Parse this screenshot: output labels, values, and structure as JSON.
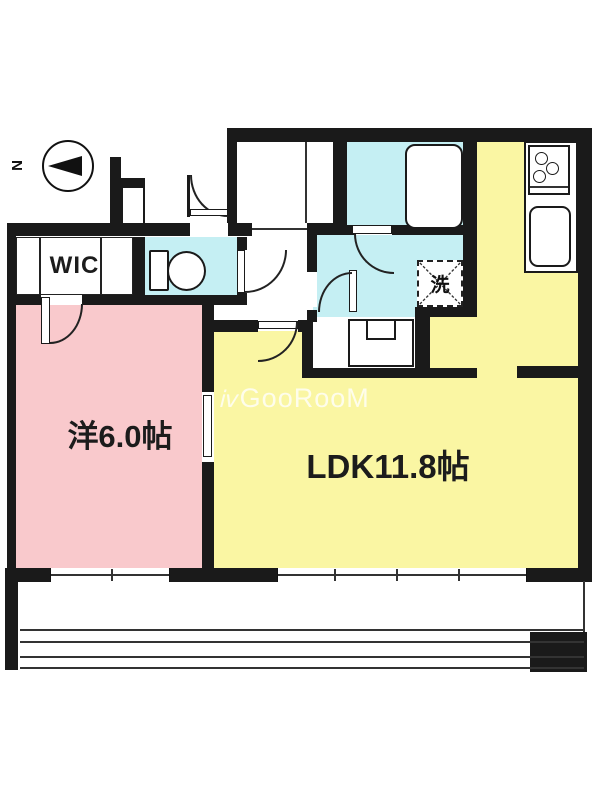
{
  "compass": {
    "label": "N"
  },
  "rooms": {
    "wic": {
      "label": "WIC"
    },
    "western": {
      "label": "洋6.0帖"
    },
    "ldk": {
      "label": "LDK11.8帖"
    },
    "laundry": {
      "label": "洗"
    }
  },
  "watermark": {
    "icon": "ⅳ",
    "text": "GooRooM"
  },
  "colors": {
    "wall": "#1a1a1a",
    "western_room": "#f9c9cc",
    "ldk": "#faf6a3",
    "wet_area": "#c5eff3"
  }
}
